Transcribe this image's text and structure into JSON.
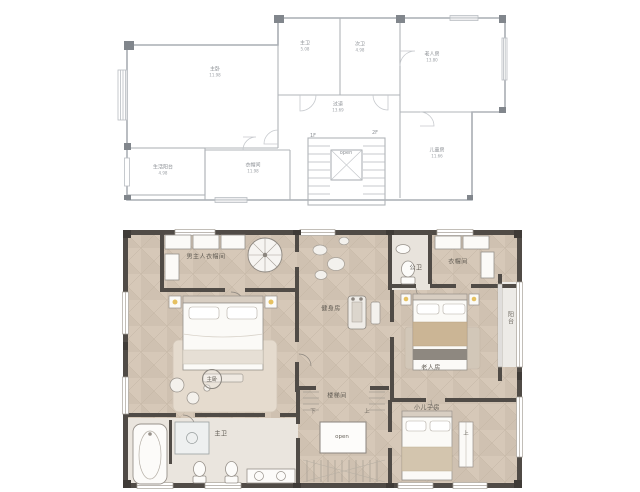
{
  "colors": {
    "upper_line": "#a9adb3",
    "upper_block": "#81868c",
    "lower_wall": "#504b46",
    "floor_base": "#dacdbe",
    "floor_facet": "#cfc1b1",
    "bath_floor": "#eae5de",
    "lamp_accent": "#e6c161",
    "blanket_tan": "#cbb595"
  },
  "upper_plan": {
    "rooms": {
      "master_bedroom": {
        "label": "主卧",
        "area": "11.98"
      },
      "master_bath": {
        "label": "主卫",
        "area": "5.08"
      },
      "second_bath": {
        "label": "次卫",
        "area": "4.98"
      },
      "elder_room": {
        "label": "老人房",
        "area": "13.80"
      },
      "corridor": {
        "label": "过道",
        "area": "13.69"
      },
      "service_balcony": {
        "label": "生活阳台",
        "area": "4.98"
      },
      "cloak_room": {
        "label": "衣帽间",
        "area": "11.98"
      },
      "kids_room": {
        "label": "儿童房",
        "area": "11.66"
      }
    },
    "stair": {
      "mark_down": "1F",
      "mark_up": "2F",
      "open_label": "open"
    }
  },
  "lower_plan": {
    "rooms": {
      "mens_closet": {
        "label": "男主人衣帽间"
      },
      "public_bath": {
        "label": "公卫"
      },
      "closet": {
        "label": "衣帽间"
      },
      "gym": {
        "label": "健身房"
      },
      "master_bedroom": {
        "label": "主卧"
      },
      "elder_room": {
        "label": "老人房"
      },
      "balcony": {
        "label": "阳台"
      },
      "stair_room": {
        "label": "楼梯间"
      },
      "young_son_room": {
        "label": "小儿子房"
      },
      "master_bath": {
        "label": "主卫"
      }
    },
    "stair": {
      "down": "下",
      "up": "上",
      "open_label": "open",
      "up_secondary": "上"
    }
  }
}
